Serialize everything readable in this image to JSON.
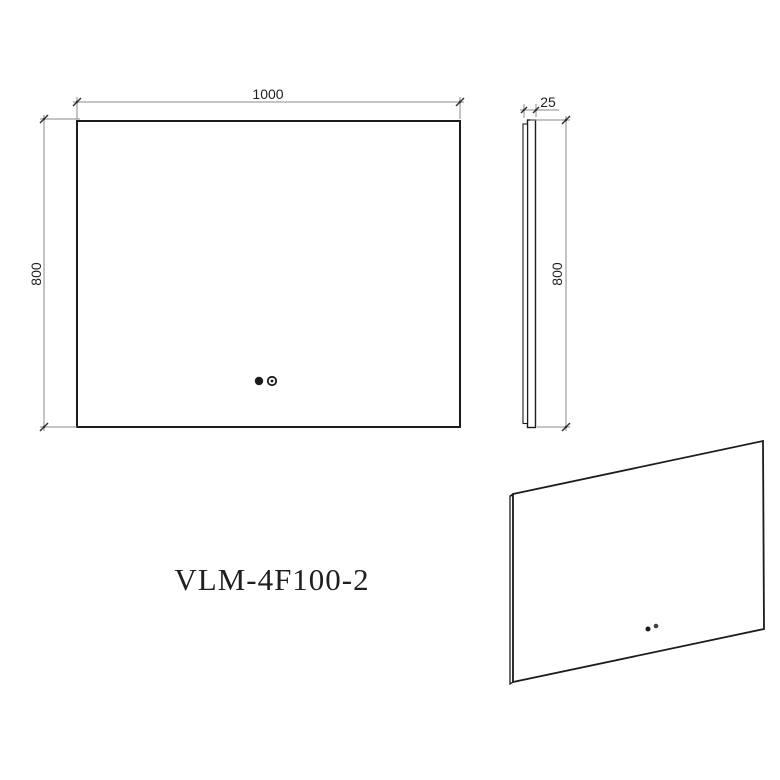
{
  "drawing": {
    "product_label": "VLM-4F100-2",
    "dimensions": {
      "front_width": "1000",
      "front_height": "800",
      "side_depth": "25",
      "side_height": "800"
    },
    "icons": {
      "sensor_left": "touch-sensor-filled-dot",
      "sensor_right": "touch-sensor-ring-dot"
    },
    "colors": {
      "object_line": "#1c1c1c",
      "dimension_line": "#8a8a8a",
      "tick": "#2f2f2f",
      "text": "#1f1f1f",
      "background": "#ffffff"
    }
  }
}
